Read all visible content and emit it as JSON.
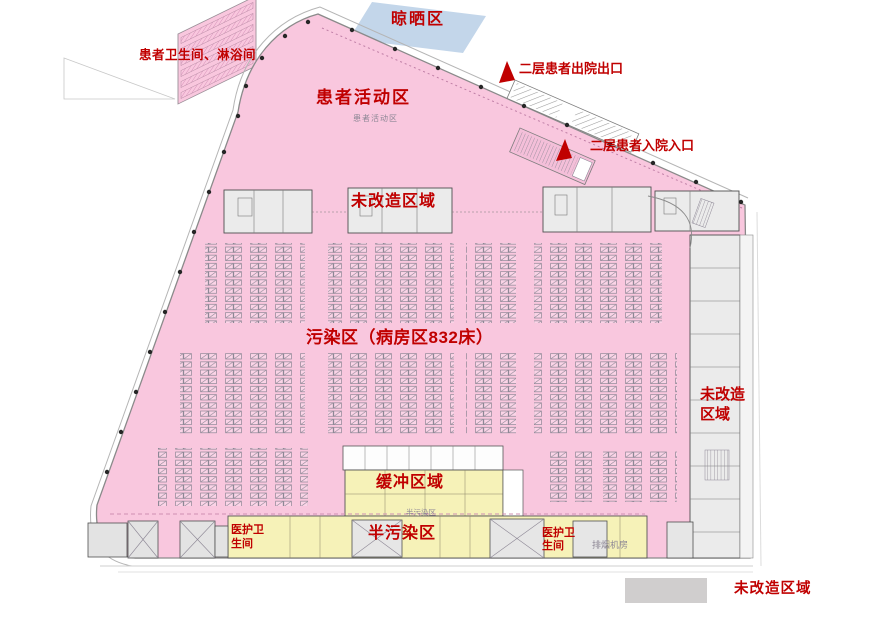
{
  "plan": {
    "zones": {
      "drying_area": "晾晒区",
      "patient_toilet_shower": "患者卫生间、淋浴间",
      "patient_activity": "患者活动区",
      "patient_activity_room_tag": "患者活动区",
      "discharge_exit": "二层患者出院出口",
      "admission_entrance": "二层患者入院入口",
      "unrenovated_top": "未改造区域",
      "contaminated_ward": "污染区（病房区832床）",
      "buffer_zone": "缓冲区域",
      "semi_contaminated": "半污染区",
      "semi_contaminated_room_tag": "半污染区",
      "staff_toilet_left": "医护卫\n生间",
      "staff_toilet_right": "医护卫\n生间",
      "smoke_exhaust_room": "排烟机房",
      "unrenovated_right": "未改造\n区域"
    },
    "stats": {
      "ward_beds": 832
    },
    "legend": {
      "unrenovated": "未改造区域"
    },
    "colors": {
      "contaminated_pink": "#f9c7de",
      "semi_contaminated_yellow": "#f6f2b8",
      "drying_blue": "#c3d6ea",
      "label_red": "#c00000",
      "unrenovated_gray": "#d0cece"
    }
  }
}
